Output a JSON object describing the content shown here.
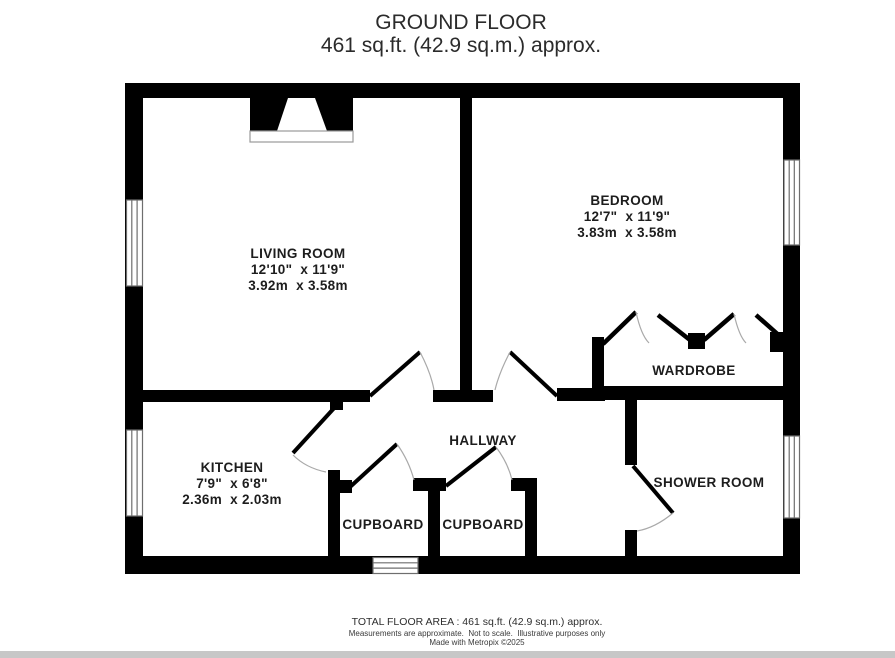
{
  "title": {
    "line1": "GROUND FLOOR",
    "line2": "461 sq.ft. (42.9 sq.m.) approx."
  },
  "rooms": {
    "living_room": {
      "name": "LIVING ROOM",
      "imperial": "12'10\"  x 11'9\"",
      "metric": "3.92m  x 3.58m"
    },
    "bedroom": {
      "name": "BEDROOM",
      "imperial": "12'7\"  x 11'9\"",
      "metric": "3.83m  x 3.58m"
    },
    "kitchen": {
      "name": "KITCHEN",
      "imperial": "7'9\"  x 6'8\"",
      "metric": "2.36m  x 2.03m"
    },
    "hallway": {
      "name": "HALLWAY"
    },
    "wardrobe": {
      "name": "WARDROBE"
    },
    "cupboard_1": {
      "name": "CUPBOARD"
    },
    "cupboard_2": {
      "name": "CUPBOARD"
    },
    "shower_room": {
      "name": "SHOWER ROOM"
    }
  },
  "footer": {
    "total_area": "TOTAL FLOOR AREA : 461 sq.ft. (42.9 sq.m.) approx.",
    "disclaimer": "Measurements are approximate.  Not to scale.  Illustrative purposes only",
    "credit": "Made with Metropix ©2025"
  },
  "colors": {
    "wall": "#000000",
    "background": "#ffffff",
    "door_arc": "#a9a9a9",
    "window_frame": "#6e6e6e",
    "text": "#1d1d1d",
    "bottom_bar": "#c7c7c7"
  }
}
